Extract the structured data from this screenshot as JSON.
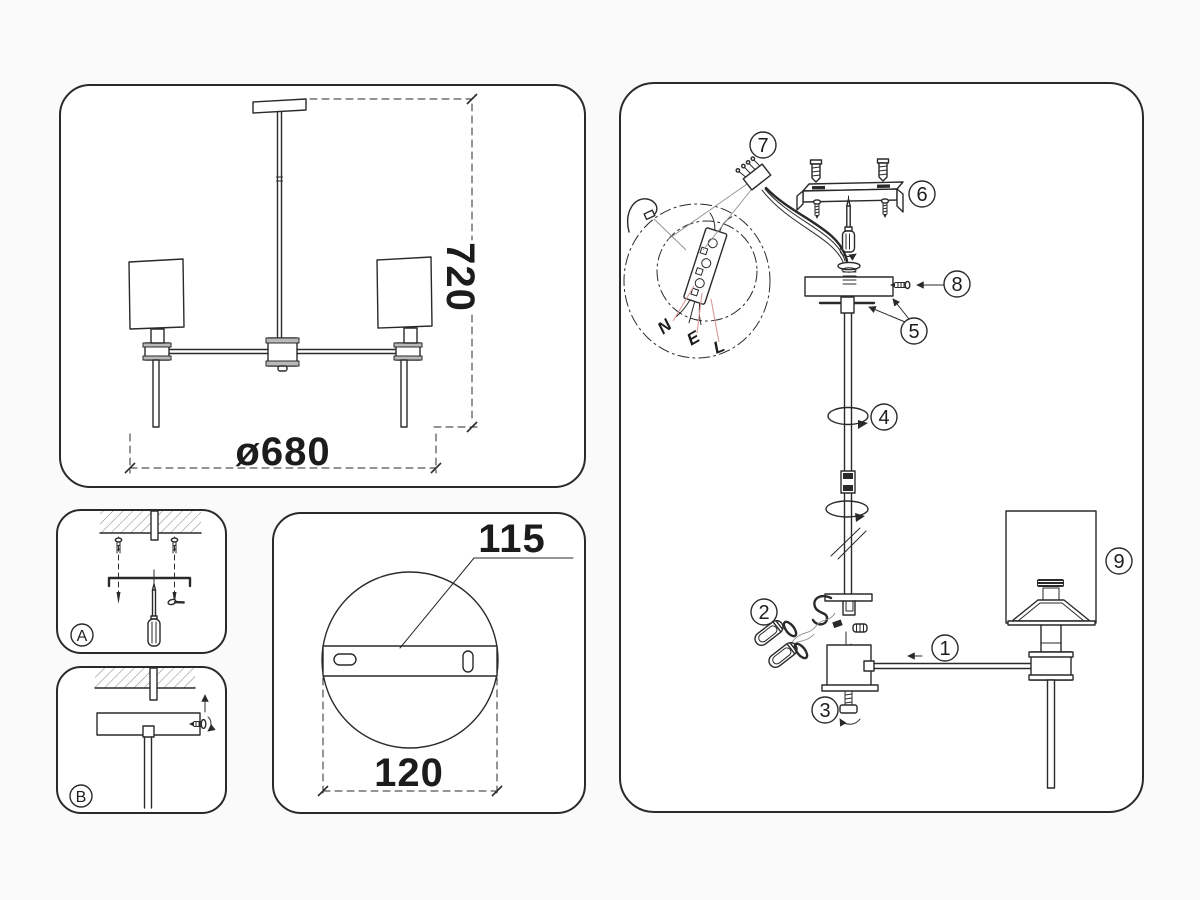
{
  "figure": {
    "type": "lighting-fixture-assembly-instructions",
    "background_color": "#fafafa",
    "line_color": "#2a2a2a",
    "wire_label_leader_color": "#dd9898"
  },
  "front_view": {
    "height_dimension": "720",
    "diameter_dimension": "ø680"
  },
  "mount_plate_detail": {
    "bracket_dimension": "115",
    "plate_width_dimension": "120"
  },
  "steps": {
    "step_a_label": "A",
    "step_b_label": "B"
  },
  "exploded_view": {
    "part_numbers": [
      "1",
      "2",
      "3",
      "4",
      "5",
      "6",
      "7",
      "8",
      "9"
    ],
    "wiring_terminal_labels": {
      "neutral": "N",
      "earth": "E",
      "live": "L"
    }
  }
}
